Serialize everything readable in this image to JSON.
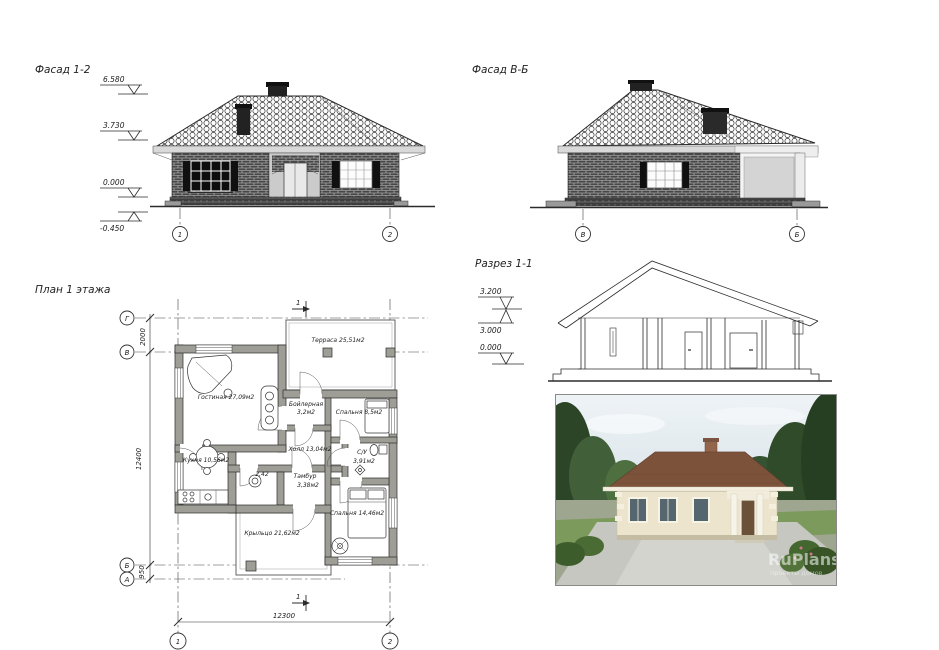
{
  "facade12": {
    "title": "Фасад 1-2",
    "lv1": "6.580",
    "lv2": "3.730",
    "lv3": "0.000",
    "lv4": "-0.450",
    "ax1": "1",
    "ax2": "2"
  },
  "facadeVB": {
    "title": "Фасад В-Б",
    "ax1": "В",
    "ax2": "Б"
  },
  "section": {
    "title": "Разрез 1-1",
    "lv1": "3.200",
    "lv2": "3.000",
    "lv3": "0.000"
  },
  "plan": {
    "title": "План 1 этажа",
    "axG": "Г",
    "axV": "В",
    "axB": "Б",
    "axA": "А",
    "ax1": "1",
    "ax2": "2",
    "dim_gv": "2000",
    "dim_left": "12400",
    "dim_ba": "950",
    "dim_bottom": "12300",
    "section_mark_top": "1",
    "section_mark_bottom": "1",
    "rooms": {
      "living": "Гостиная 27,09м2",
      "terrace": "Терраса 25,51м2",
      "boiler1": "Бойлерная",
      "boiler2": "3,2м2",
      "bedroom1": "Спальня 8,5м2",
      "hall": "Холл 13,04м2",
      "kitchen": "Кухня 10,56м2",
      "wc1": "2,42",
      "wc2a": "С/У",
      "wc2b": "3,91м2",
      "tambour1": "Тамбур",
      "tambour2": "3,38м2",
      "porch": "Крыльцо 21,62м2",
      "bedroom2": "Спальня 14,46м2"
    }
  },
  "render": {
    "watermark": "RuPlans",
    "watermark_sub": "проекты домов"
  }
}
